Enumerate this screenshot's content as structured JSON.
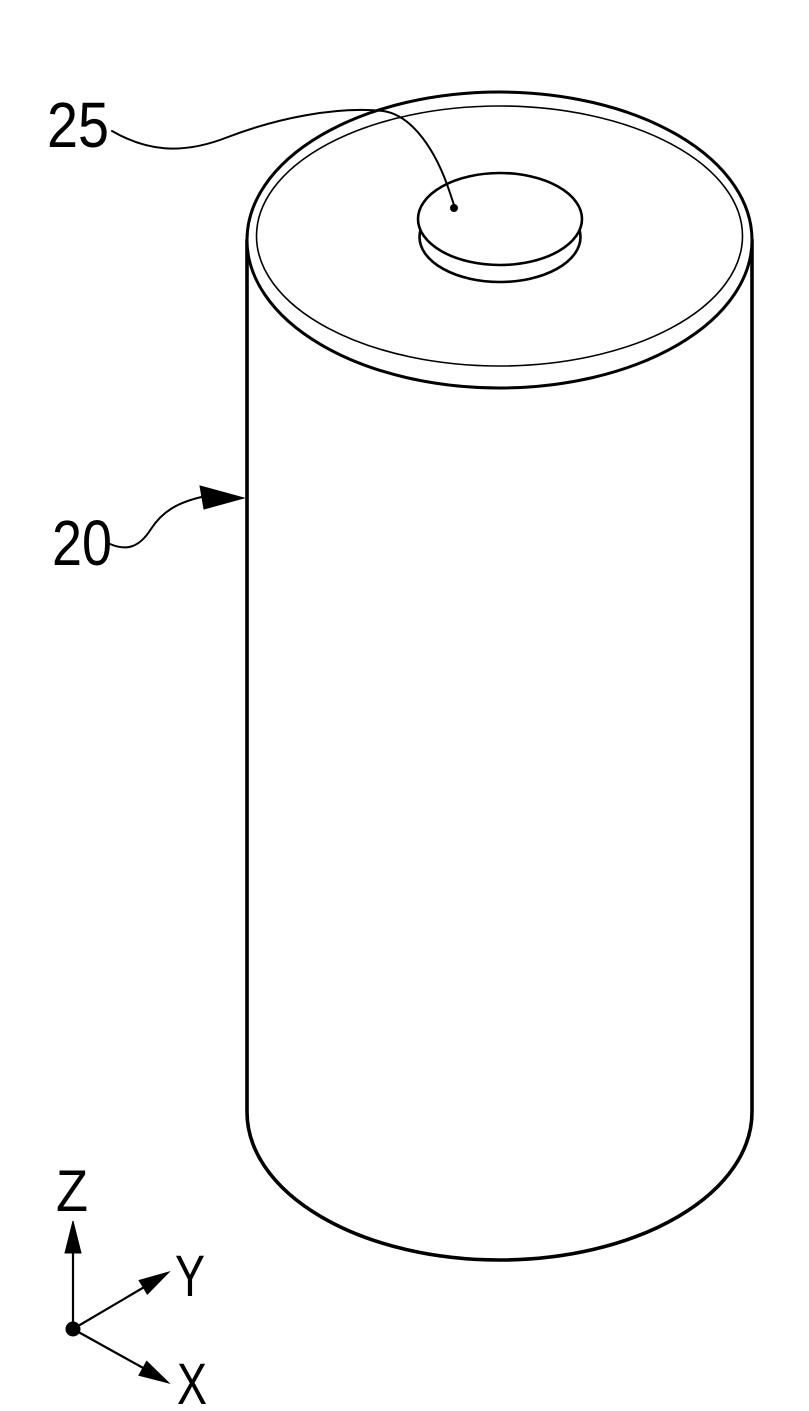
{
  "figure": {
    "background_color": "#ffffff",
    "line_color": "#000000",
    "part_labels": {
      "terminal": "25",
      "cell_body": "20"
    },
    "axes": {
      "z": "Z",
      "y": "Y",
      "x": "X"
    }
  }
}
